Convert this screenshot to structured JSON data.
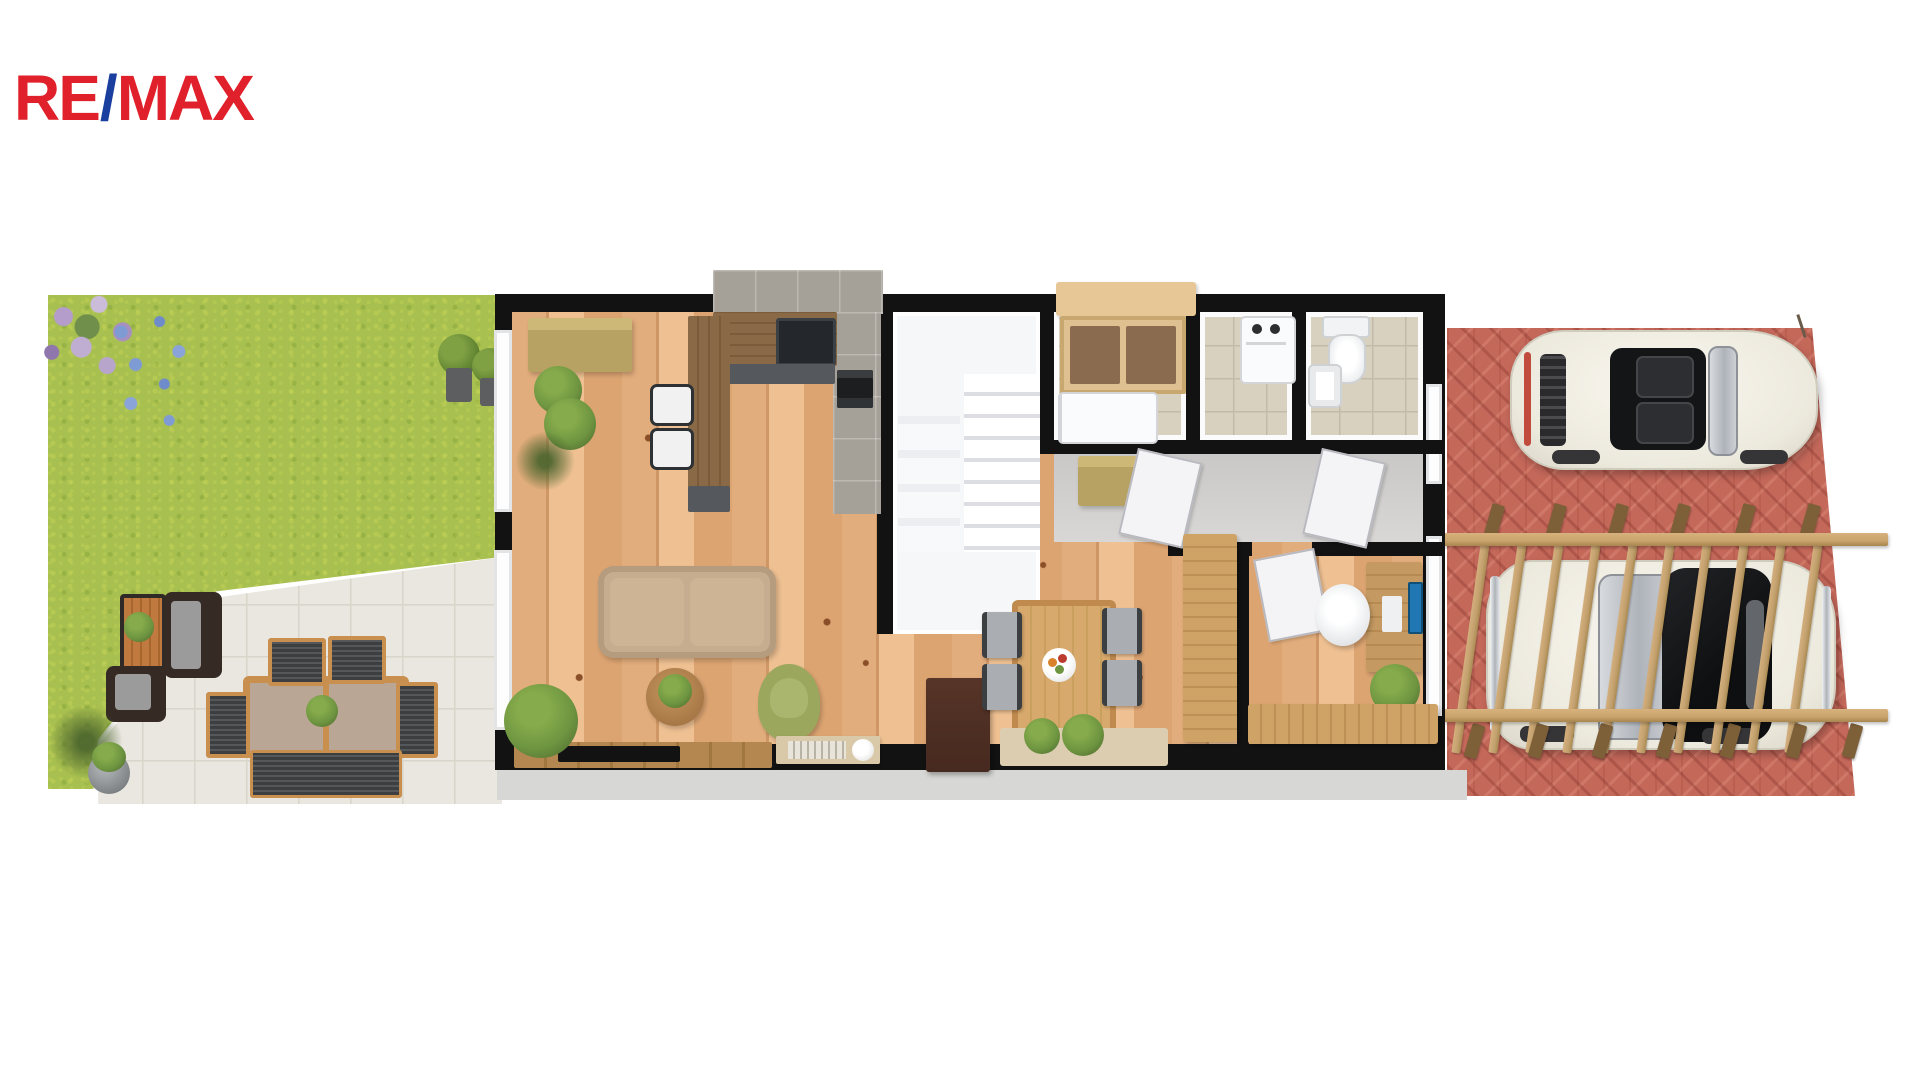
{
  "logo": {
    "re": "RE",
    "slash": "/",
    "max": "MAX"
  },
  "palette": {
    "red": "#e0202a",
    "blue": "#1b3f9f",
    "grass": "#a8c04f",
    "patio": "#e9e7df",
    "patioLine": "#d8d5ca",
    "wood": "#e2ad7c",
    "wood2": "#dca471",
    "woodDark": "#cf9765",
    "knot": "#8a4f28",
    "wall": "#121212",
    "whiteRoom": "#f6f7f8",
    "tileBeige": "#d8d1bf",
    "tileLine": "#c2bba9",
    "grayTile": "#a5a098",
    "counterWood": "#8a6a46",
    "cabinetDark": "#55585c",
    "oliveWood": "#b7a263",
    "plinth": "#d7d7d5",
    "sofaBeige": "#c7ad8f",
    "greenChair": "#9aa75d",
    "brownCab": "#46291f",
    "rug": "#dccdb0",
    "woodFurn": "#cfa265",
    "deskWood": "#c59a62",
    "screenBlue": "#2077b4",
    "brick": "#c4685a",
    "pergola": "#c9a36c",
    "post": "#7d5f38",
    "rafter": "#c2a06e",
    "carBody": "#ece9dd",
    "chromeGray": "#c3c6ca",
    "teak": "#c98f4e",
    "ttop": "#b9a694",
    "plant": "#6d9440",
    "plantDark": "#49632c",
    "doorWhite": "#f4f4f6"
  },
  "scene": {
    "type": "3d-floor-plan-render",
    "garden": {
      "items": [
        "flower-bed",
        "lawn",
        "stone-patio",
        "planter-box",
        "wicker-sofa",
        "wicker-armchair",
        "outdoor-dining-table",
        "outdoor-chairs",
        "outdoor-bench",
        "flower-pot",
        "potted-shrubs"
      ]
    },
    "house": {
      "rooms": [
        {
          "name": "living-room",
          "items": [
            "sofa",
            "coffee-table",
            "green-armchair",
            "tv-sideboard",
            "tv",
            "floor-plant",
            "side-table"
          ]
        },
        {
          "name": "kitchen",
          "items": [
            "l-counter",
            "sink",
            "oven",
            "island",
            "bar-stools",
            "sideboard",
            "plants"
          ]
        },
        {
          "name": "staircase-hall",
          "items": [
            "stairs",
            "shelving"
          ]
        },
        {
          "name": "pantry",
          "items": [
            "wardrobe",
            "counter"
          ]
        },
        {
          "name": "laundry",
          "items": [
            "washing-machine"
          ]
        },
        {
          "name": "bathroom",
          "items": [
            "toilet",
            "sink"
          ]
        },
        {
          "name": "hallway",
          "items": [
            "bench",
            "doors"
          ]
        },
        {
          "name": "dining-room",
          "items": [
            "dining-table",
            "chairs",
            "fruit-bowl",
            "cabinet",
            "rug",
            "wardrobe"
          ]
        },
        {
          "name": "office",
          "items": [
            "desk",
            "monitor",
            "office-chair",
            "plant",
            "sideboard"
          ]
        }
      ]
    },
    "driveway": {
      "items": [
        "brick-paving",
        "pergola",
        "convertible-car",
        "soft-top-car"
      ]
    }
  }
}
